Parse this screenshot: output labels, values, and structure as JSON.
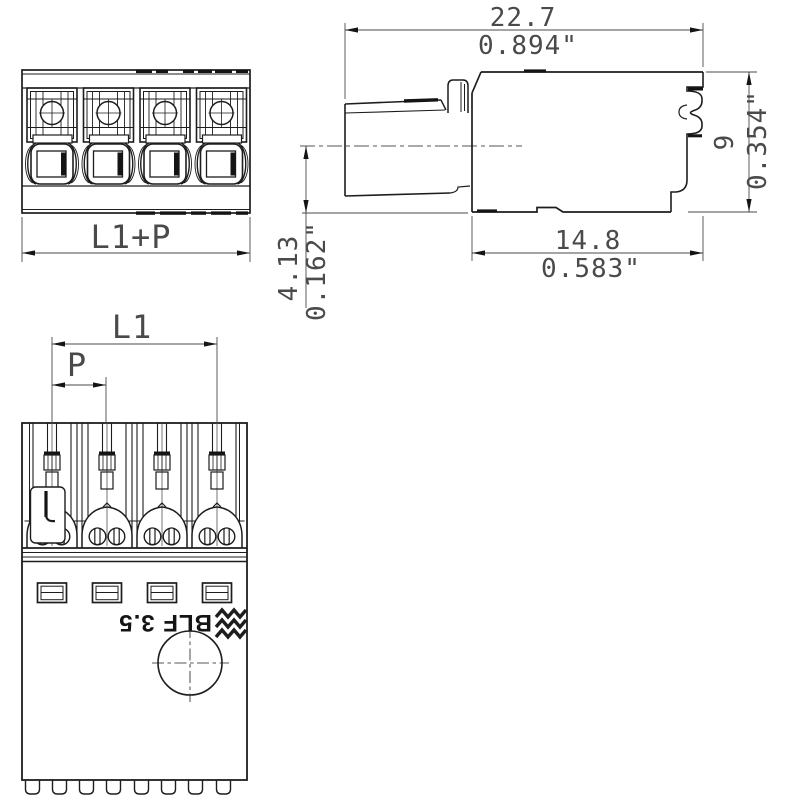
{
  "drawing": {
    "type": "technical-drawing",
    "line_color": "#1d1d1d",
    "dim_color": "#4a4a4a",
    "product": "BLF 3.5"
  },
  "front_view": {
    "dim_total_label": "L1+P"
  },
  "side_view": {
    "dim_width_mm": "22.7",
    "dim_width_in": "0.894\"",
    "dim_height_mm": "9",
    "dim_height_in": "0.354\"",
    "dim_depth_mm": "14.8",
    "dim_depth_in": "0.583\"",
    "dim_axis_mm": "4.13",
    "dim_axis_in": "0.162\""
  },
  "plug_view": {
    "dim_length_label": "L1",
    "dim_pitch_label": "P",
    "marking_text": "BLF 3.5",
    "logo": "weidmueller-logo"
  }
}
